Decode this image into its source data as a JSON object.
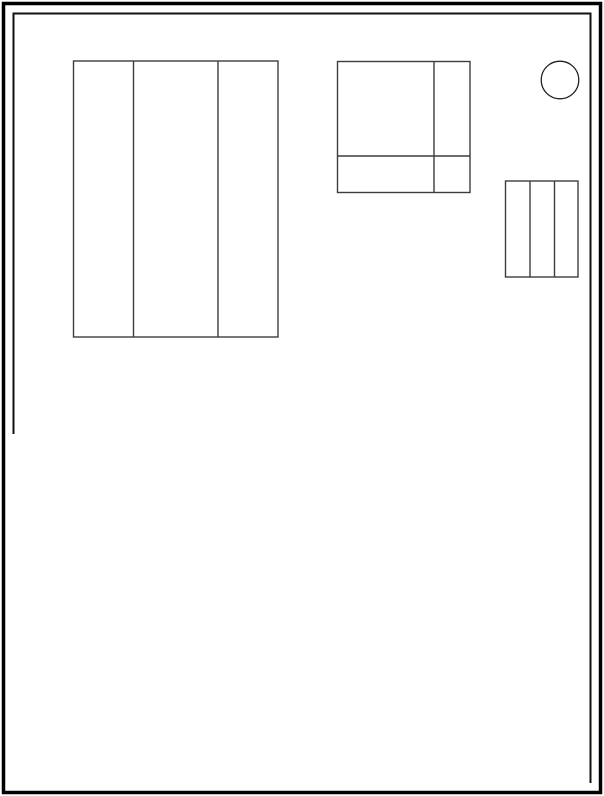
{
  "canvas": {
    "width": 604,
    "height": 796,
    "background": "#ffffff"
  },
  "outer_frame": {
    "x": 3.5,
    "y": 3.5,
    "width": 597,
    "height": 789,
    "stroke": "#000000",
    "stroke_width": 3.5
  },
  "inner_frame": {
    "comment_shape": "partial inner border: left edge stops partway down, no bottom edge",
    "points": "13.5,433 13.5,13.5 590.5,13.5 590.5,782",
    "stroke": "#121212",
    "stroke_width": 2
  },
  "shapes": [
    {
      "name": "three-column-rect-large",
      "type": "rect",
      "x": 73.5,
      "y": 61,
      "width": 204.5,
      "height": 276,
      "dividers_x": [
        133.5,
        218
      ],
      "dividers_y": [],
      "stroke": "#3d3d3d",
      "stroke_width": 1.4
    },
    {
      "name": "grid-square",
      "type": "rect",
      "x": 337.5,
      "y": 61.5,
      "width": 132.5,
      "height": 131,
      "dividers_x": [
        434
      ],
      "dividers_y": [
        156
      ],
      "stroke": "#3d3d3d",
      "stroke_width": 1.4
    },
    {
      "name": "circle-shape",
      "type": "circle",
      "cx": 560,
      "cy": 80,
      "r": 18.8,
      "stroke": "#222222",
      "stroke_width": 1.3
    },
    {
      "name": "three-column-rect-small",
      "type": "rect",
      "x": 505.5,
      "y": 181,
      "width": 72.5,
      "height": 96,
      "dividers_x": [
        530,
        554.5
      ],
      "dividers_y": [],
      "stroke": "#3d3d3d",
      "stroke_width": 1.4
    }
  ]
}
